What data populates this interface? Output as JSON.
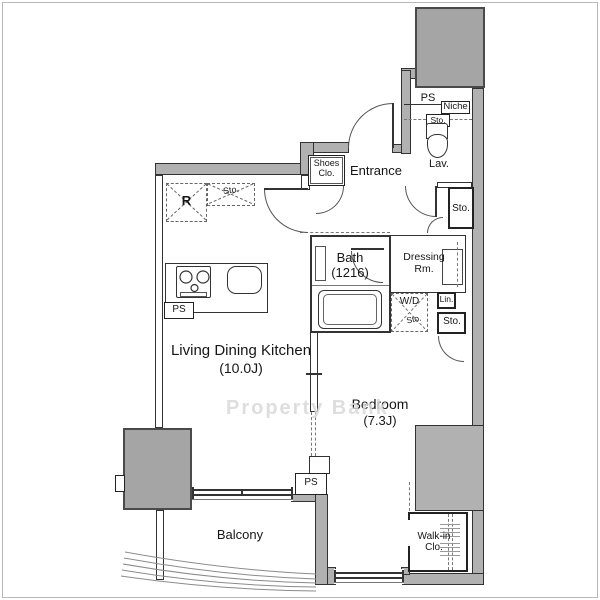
{
  "watermark": "Property Bank",
  "rooms": {
    "ldk": {
      "name": "Living Dining Kitchen",
      "size": "(10.0J)"
    },
    "bedroom": {
      "name": "Bedroom",
      "size": "(7.3J)"
    },
    "bath": {
      "name": "Bath",
      "size": "(1216)"
    },
    "entrance": {
      "name": "Entrance"
    },
    "balcony": {
      "name": "Balcony"
    },
    "lavatory": {
      "name": "Lav."
    },
    "dressing_room": {
      "line1": "Dressing",
      "line2": "Rm."
    },
    "walk_in_closet": {
      "line1": "Walk-in",
      "line2": "Clo."
    },
    "shoes_closet": {
      "line1": "Shoes",
      "line2": "Clo."
    }
  },
  "labels": {
    "pipe_space": "PS",
    "niche": "Niche",
    "storage": "Sto.",
    "linen": "Lin.",
    "washer_dryer": "W/D",
    "refrigerator": "R"
  },
  "colors": {
    "wall_fill": "#b1b1b1",
    "block_fill": "#a5a5a5",
    "line": "#333333",
    "watermark": "#d9d9d9",
    "background": "#ffffff"
  }
}
